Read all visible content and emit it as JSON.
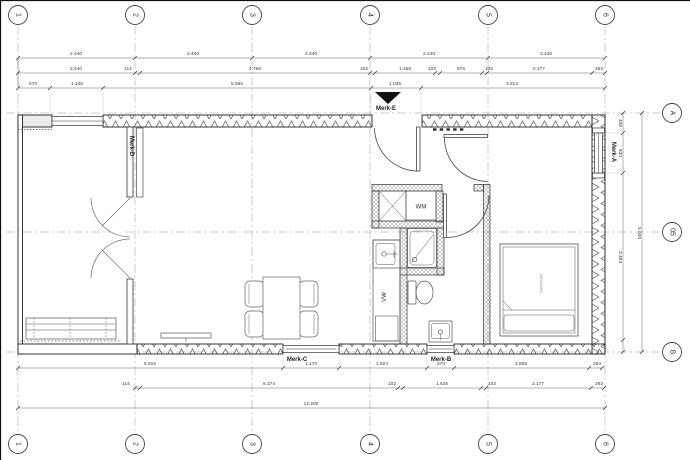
{
  "drawing": {
    "grid_cols": [
      "1",
      "2",
      "3",
      "4",
      "5",
      "6"
    ],
    "grid_rows": [
      "A",
      "05",
      "B"
    ],
    "dims": {
      "top1": [
        "2.440",
        "2.440",
        "2.440",
        "2.440",
        "2.440"
      ],
      "top2": [
        "2.440",
        "114",
        "4.766",
        "102",
        "1.258",
        "102",
        "876",
        "102",
        "2.177",
        "263"
      ],
      "top3": [
        "670",
        "1.100",
        "5.580",
        "1.036",
        "3.814"
      ],
      "bottom1": [
        "5.515",
        "1.170",
        "1.824",
        "570",
        "2.808",
        "263"
      ],
      "bottom2": [
        "114",
        "5.374",
        "102",
        "1.626",
        "102",
        "2.177",
        "263"
      ],
      "bottom3": [
        "12.200"
      ],
      "right_inner": [
        "406",
        "830",
        "3.484"
      ],
      "right_outer": [
        "5.000"
      ]
    },
    "marks": {
      "a": "Merk-A",
      "b": "Merk-B",
      "c": "Merk-C",
      "d": "Merk-D",
      "e": "Merk-E"
    },
    "fixtures": {
      "wm": "WM",
      "vw": "VW",
      "bed": "1800x2000"
    }
  }
}
